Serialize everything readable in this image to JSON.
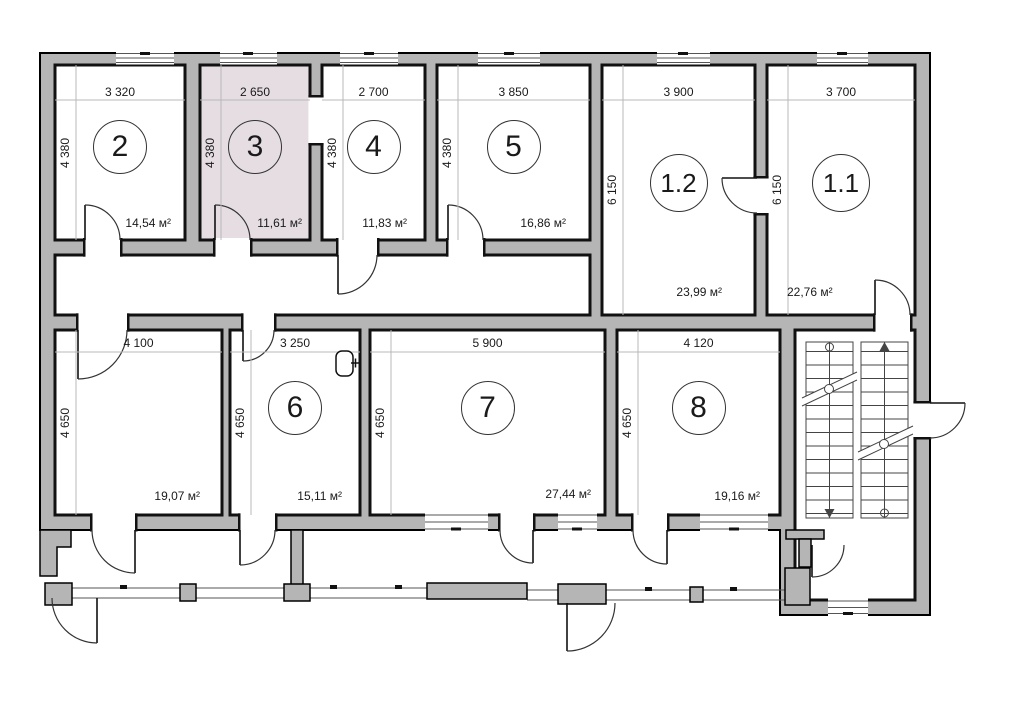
{
  "plan": {
    "title": "Floor plan",
    "units_note": "м²",
    "colors": {
      "wall": "#b5b5b5",
      "room3_highlight": "#e5dde2",
      "line": "#1a1a1a"
    },
    "icons": {
      "room6_fixture": "boiler-icon",
      "stairs_up": "arrow-up-icon",
      "stairs_down": "arrow-down-icon"
    },
    "rooms": [
      {
        "number": "2",
        "width": "3 320",
        "depth": "4 380",
        "area": "14,54 м²"
      },
      {
        "number": "3",
        "width": "2 650",
        "depth": "4 380",
        "area": "11,61 м²",
        "highlighted": true
      },
      {
        "number": "4",
        "width": "2 700",
        "depth": "4 380",
        "area": "11,83 м²"
      },
      {
        "number": "5",
        "width": "3 850",
        "depth": "4 380",
        "area": "16,86 м²"
      },
      {
        "number": "1.2",
        "width": "3 900",
        "depth": "6 150",
        "area": "23,99 м²"
      },
      {
        "number": "1.1",
        "width": "3 700",
        "depth": "6 150",
        "area": "22,76 м²"
      },
      {
        "number": "",
        "width": "4 100",
        "depth": "4 650",
        "area": "19,07 м²"
      },
      {
        "number": "6",
        "width": "3 250",
        "depth": "4 650",
        "area": "15,11 м²"
      },
      {
        "number": "7",
        "width": "5 900",
        "depth": "4 650",
        "area": "27,44 м²"
      },
      {
        "number": "8",
        "width": "4 120",
        "depth": "4 650",
        "area": "19,16 м²"
      }
    ]
  }
}
